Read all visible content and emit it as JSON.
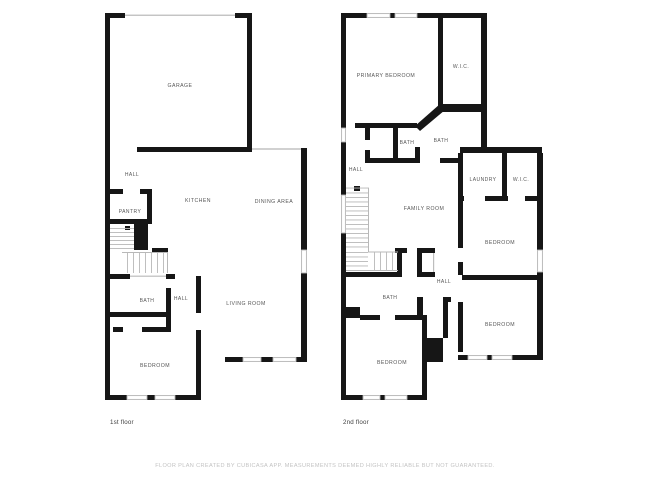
{
  "floor1": {
    "caption": "1st floor",
    "rooms": [
      {
        "label": "GARAGE"
      },
      {
        "label": "HALL"
      },
      {
        "label": "PANTRY"
      },
      {
        "label": "KITCHEN"
      },
      {
        "label": "DINING AREA"
      },
      {
        "label": "BATH"
      },
      {
        "label": "HALL"
      },
      {
        "label": "LIVING ROOM"
      },
      {
        "label": "BEDROOM"
      }
    ]
  },
  "floor2": {
    "caption": "2nd floor",
    "rooms": [
      {
        "label": "PRIMARY BEDROOM"
      },
      {
        "label": "W.I.C."
      },
      {
        "label": "BATH"
      },
      {
        "label": "BATH"
      },
      {
        "label": "HALL"
      },
      {
        "label": "LAUNDRY"
      },
      {
        "label": "W.I.C."
      },
      {
        "label": "FAMILY ROOM"
      },
      {
        "label": "BEDROOM"
      },
      {
        "label": "HALL"
      },
      {
        "label": "BATH"
      },
      {
        "label": "BEDROOM"
      },
      {
        "label": "BEDROOM"
      }
    ]
  },
  "footer": {
    "disclaimer": "FLOOR PLAN CREATED BY CUBICASA APP. MEASUREMENTS DEEMED HIGHLY RELIABLE BUT NOT GUARANTEED."
  },
  "colors": {
    "wall": "#161616",
    "window_frame": "#b3b3b3",
    "stair_tread": "#b8b8b8",
    "room_label": "#575757",
    "floor_caption": "#3f3f3f",
    "footer_text": "#c3c3c3",
    "background": "#ffffff"
  }
}
